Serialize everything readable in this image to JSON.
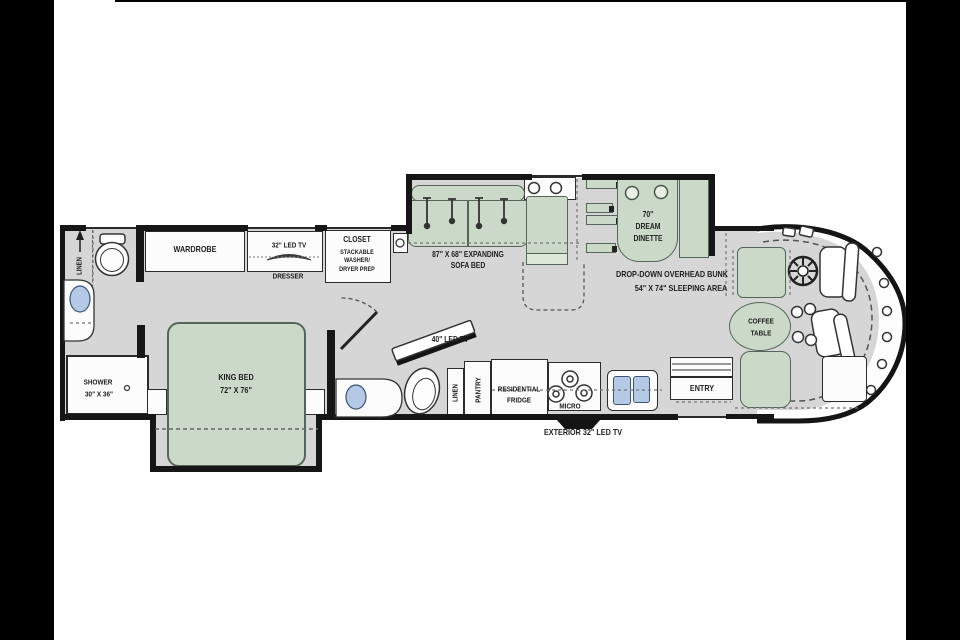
{
  "colors": {
    "furniture_green": "#cbdac8",
    "floor_gray": "#d6d6d6",
    "wall_black": "#141414",
    "window_blue": "#b3c9e6",
    "letterbox_black": "#000000"
  },
  "rear_bath": {
    "linen": "LINEN",
    "shower_l1": "SHOWER",
    "shower_l2": "30\" X 36\""
  },
  "bedroom": {
    "wardrobe": "WARDROBE",
    "tv": "32\" LED TV",
    "dresser": "DRESSER",
    "closet_l1": "CLOSET",
    "closet_l2": "STACKABLE",
    "closet_l3": "WASHER/",
    "closet_l4": "DRYER PREP",
    "bed_l1": "KING BED",
    "bed_l2": "72\" X 76\""
  },
  "mid_bath": {
    "tv": "40\" LED TV"
  },
  "galley": {
    "linen": "LINEN",
    "pantry": "PANTRY",
    "fridge_l1": "RESIDENTIAL",
    "fridge_l2": "FRIDGE",
    "micro": "MICRO",
    "exterior_tv": "EXTERIOR 32\" LED TV"
  },
  "living": {
    "sofa_l1": "87\" X 68\" EXPANDING",
    "sofa_l2": "SOFA BED",
    "dinette_l1": "70\"",
    "dinette_l2": "DREAM",
    "dinette_l3": "DINETTE",
    "bunk_l1": "DROP-DOWN OVERHEAD BUNK",
    "bunk_l2": "54\" X 74\" SLEEPING AREA"
  },
  "front": {
    "coffee_l1": "COFFEE",
    "coffee_l2": "TABLE",
    "entry": "ENTRY"
  }
}
